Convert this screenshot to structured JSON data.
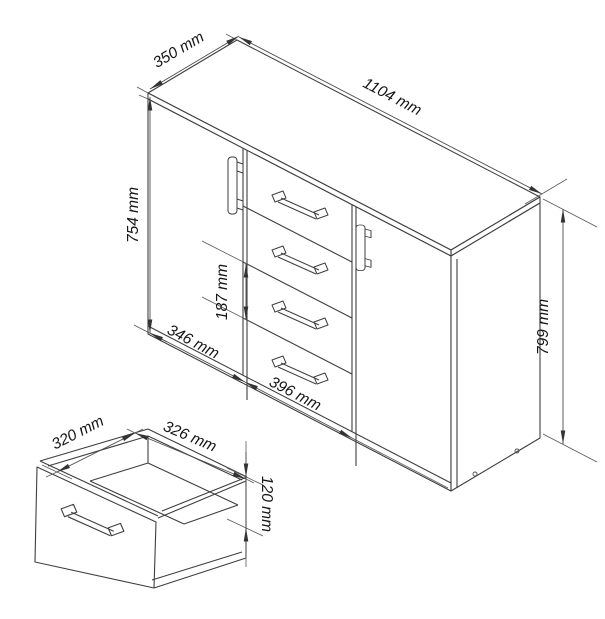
{
  "drawing": {
    "units": "mm",
    "colors": {
      "line": "#3f3f3f",
      "dimension_line": "#4c4c4c",
      "text": "#161616",
      "background": "#ffffff"
    },
    "cabinet": {
      "dim_depth": "350 mm",
      "dim_width": "1104 mm",
      "dim_front_height": "754 mm",
      "dim_drawer_pitch": "187 mm",
      "dim_left_section_width": "346 mm",
      "dim_drawer_section_width": "396 mm",
      "dim_total_height": "799 mm"
    },
    "drawer_detail": {
      "dim_depth": "320 mm",
      "dim_width": "326 mm",
      "dim_height": "120 mm"
    }
  }
}
